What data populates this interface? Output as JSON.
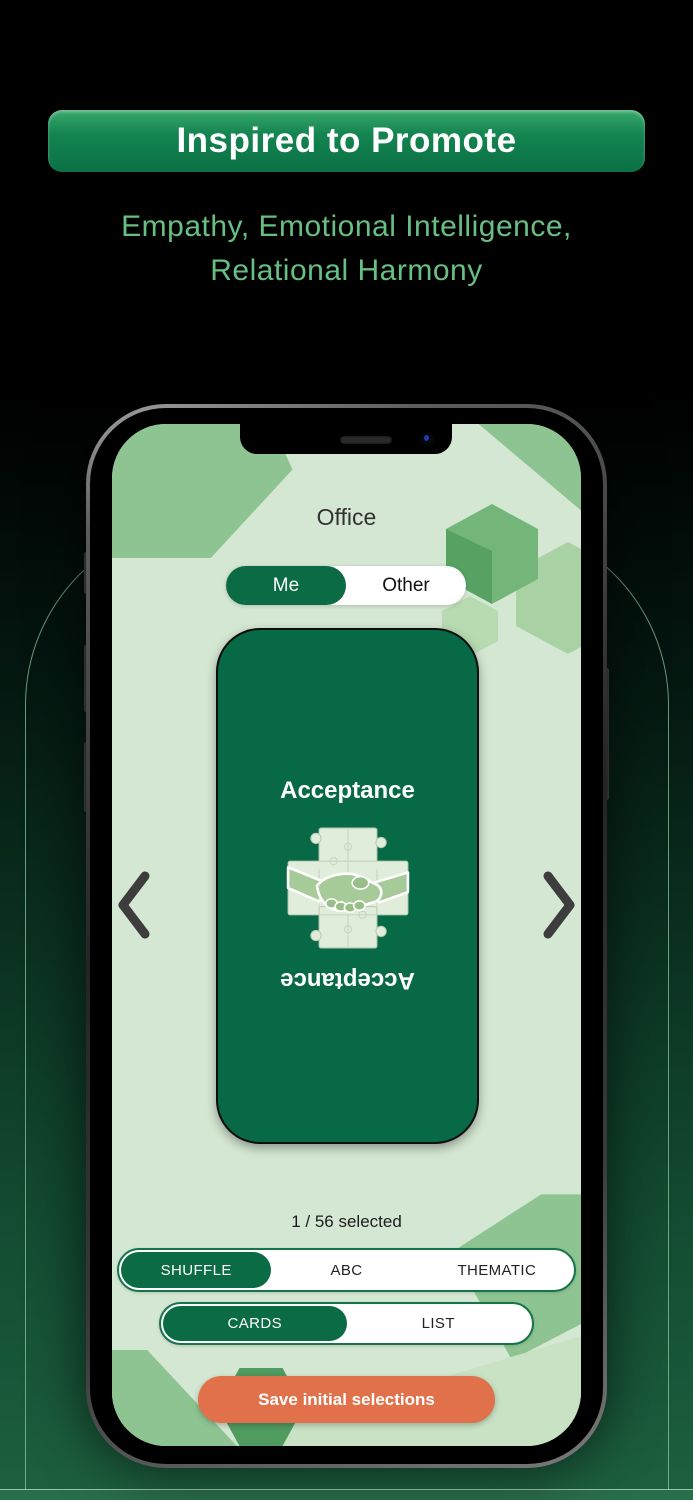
{
  "banner": {
    "title": "Inspired to Promote"
  },
  "tagline": {
    "line1": "Empathy, Emotional Intelligence,",
    "line2": "Relational Harmony"
  },
  "phone": {
    "screen": {
      "header": {
        "title": "Office"
      },
      "subject_toggle": {
        "options": [
          {
            "label": "Me",
            "selected": true
          },
          {
            "label": "Other",
            "selected": false
          }
        ]
      },
      "card": {
        "title": "Acceptance",
        "mirrored_title": "Acceptance",
        "image": "handshake-puzzle-illustration"
      },
      "carousel": {
        "prev_icon": "chevron-left-icon",
        "next_icon": "chevron-right-icon"
      },
      "selection_status": "1 / 56 selected",
      "sort_toggle": {
        "options": [
          {
            "label": "SHUFFLE",
            "selected": true
          },
          {
            "label": "ABC",
            "selected": false
          },
          {
            "label": "THEMATIC",
            "selected": false
          }
        ]
      },
      "view_toggle": {
        "options": [
          {
            "label": "CARDS",
            "selected": true
          },
          {
            "label": "LIST",
            "selected": false
          }
        ]
      },
      "save_button": {
        "label": "Save initial selections"
      }
    }
  },
  "colors": {
    "brand_green": "#0B6B45",
    "card_green": "#076946",
    "accent_orange": "#E0714B",
    "screen_bg": "#D4E7D2",
    "tagline_green": "#68BF83",
    "banner_gradient_top": "#38A569",
    "banner_gradient_bottom": "#0A7044"
  }
}
